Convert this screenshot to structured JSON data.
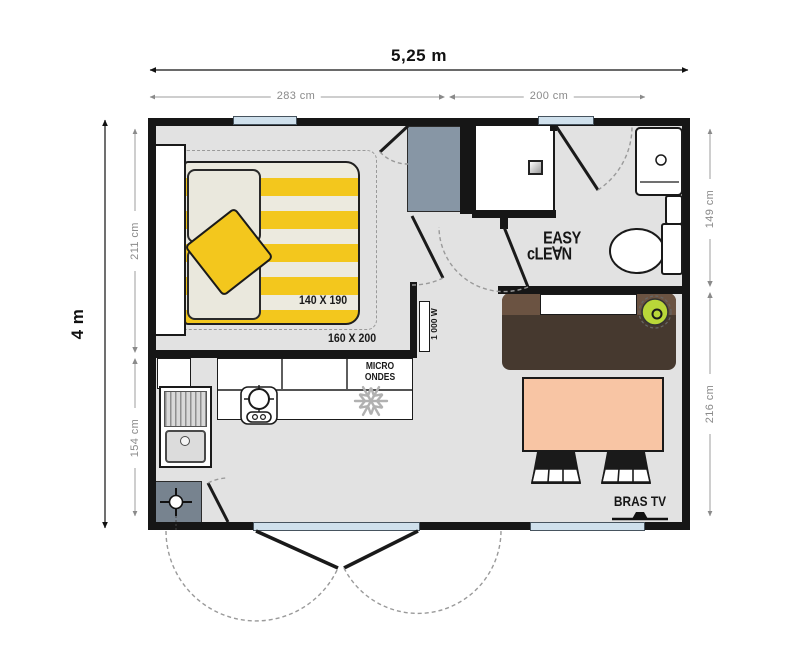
{
  "plan": {
    "title": "mobile-home floor plan",
    "dimensions": {
      "width_total": "5,25 m",
      "width_left": "283 cm",
      "width_right": "200 cm",
      "height_total": "4 m",
      "height_left_top": "211 cm",
      "height_left_bottom": "154 cm",
      "height_right_top": "149 cm",
      "height_right_bottom": "216 cm"
    },
    "labels": {
      "mattress_size": "140 X 190",
      "bed_footprint": "160 X 200",
      "microwave_line1": "MICRO",
      "microwave_line2": "ONDES",
      "heater_power": "1 000 W",
      "tv_bracket": "BRAS TV",
      "logo_line1": "EASY",
      "logo_line2": "cLE∀N"
    },
    "icons": {
      "fridge_freezer": "snowflake-icon",
      "water_heater": "crosshair-icon",
      "hob": "burner-icon",
      "tv": "tv-bracket-icon"
    },
    "colors": {
      "wall": "#161616",
      "floor": "#e2e2e2",
      "accent_yellow": "#f3c71d",
      "table_salmon": "#f8c5a4",
      "sofa_brown": "#46392f",
      "sofa_brown_light": "#6b5342",
      "stool_green": "#b9d739",
      "window_blue": "#cfe0ec",
      "wardrobe_gray": "#8796a5",
      "dimension_gray": "#8a8a8a"
    }
  }
}
